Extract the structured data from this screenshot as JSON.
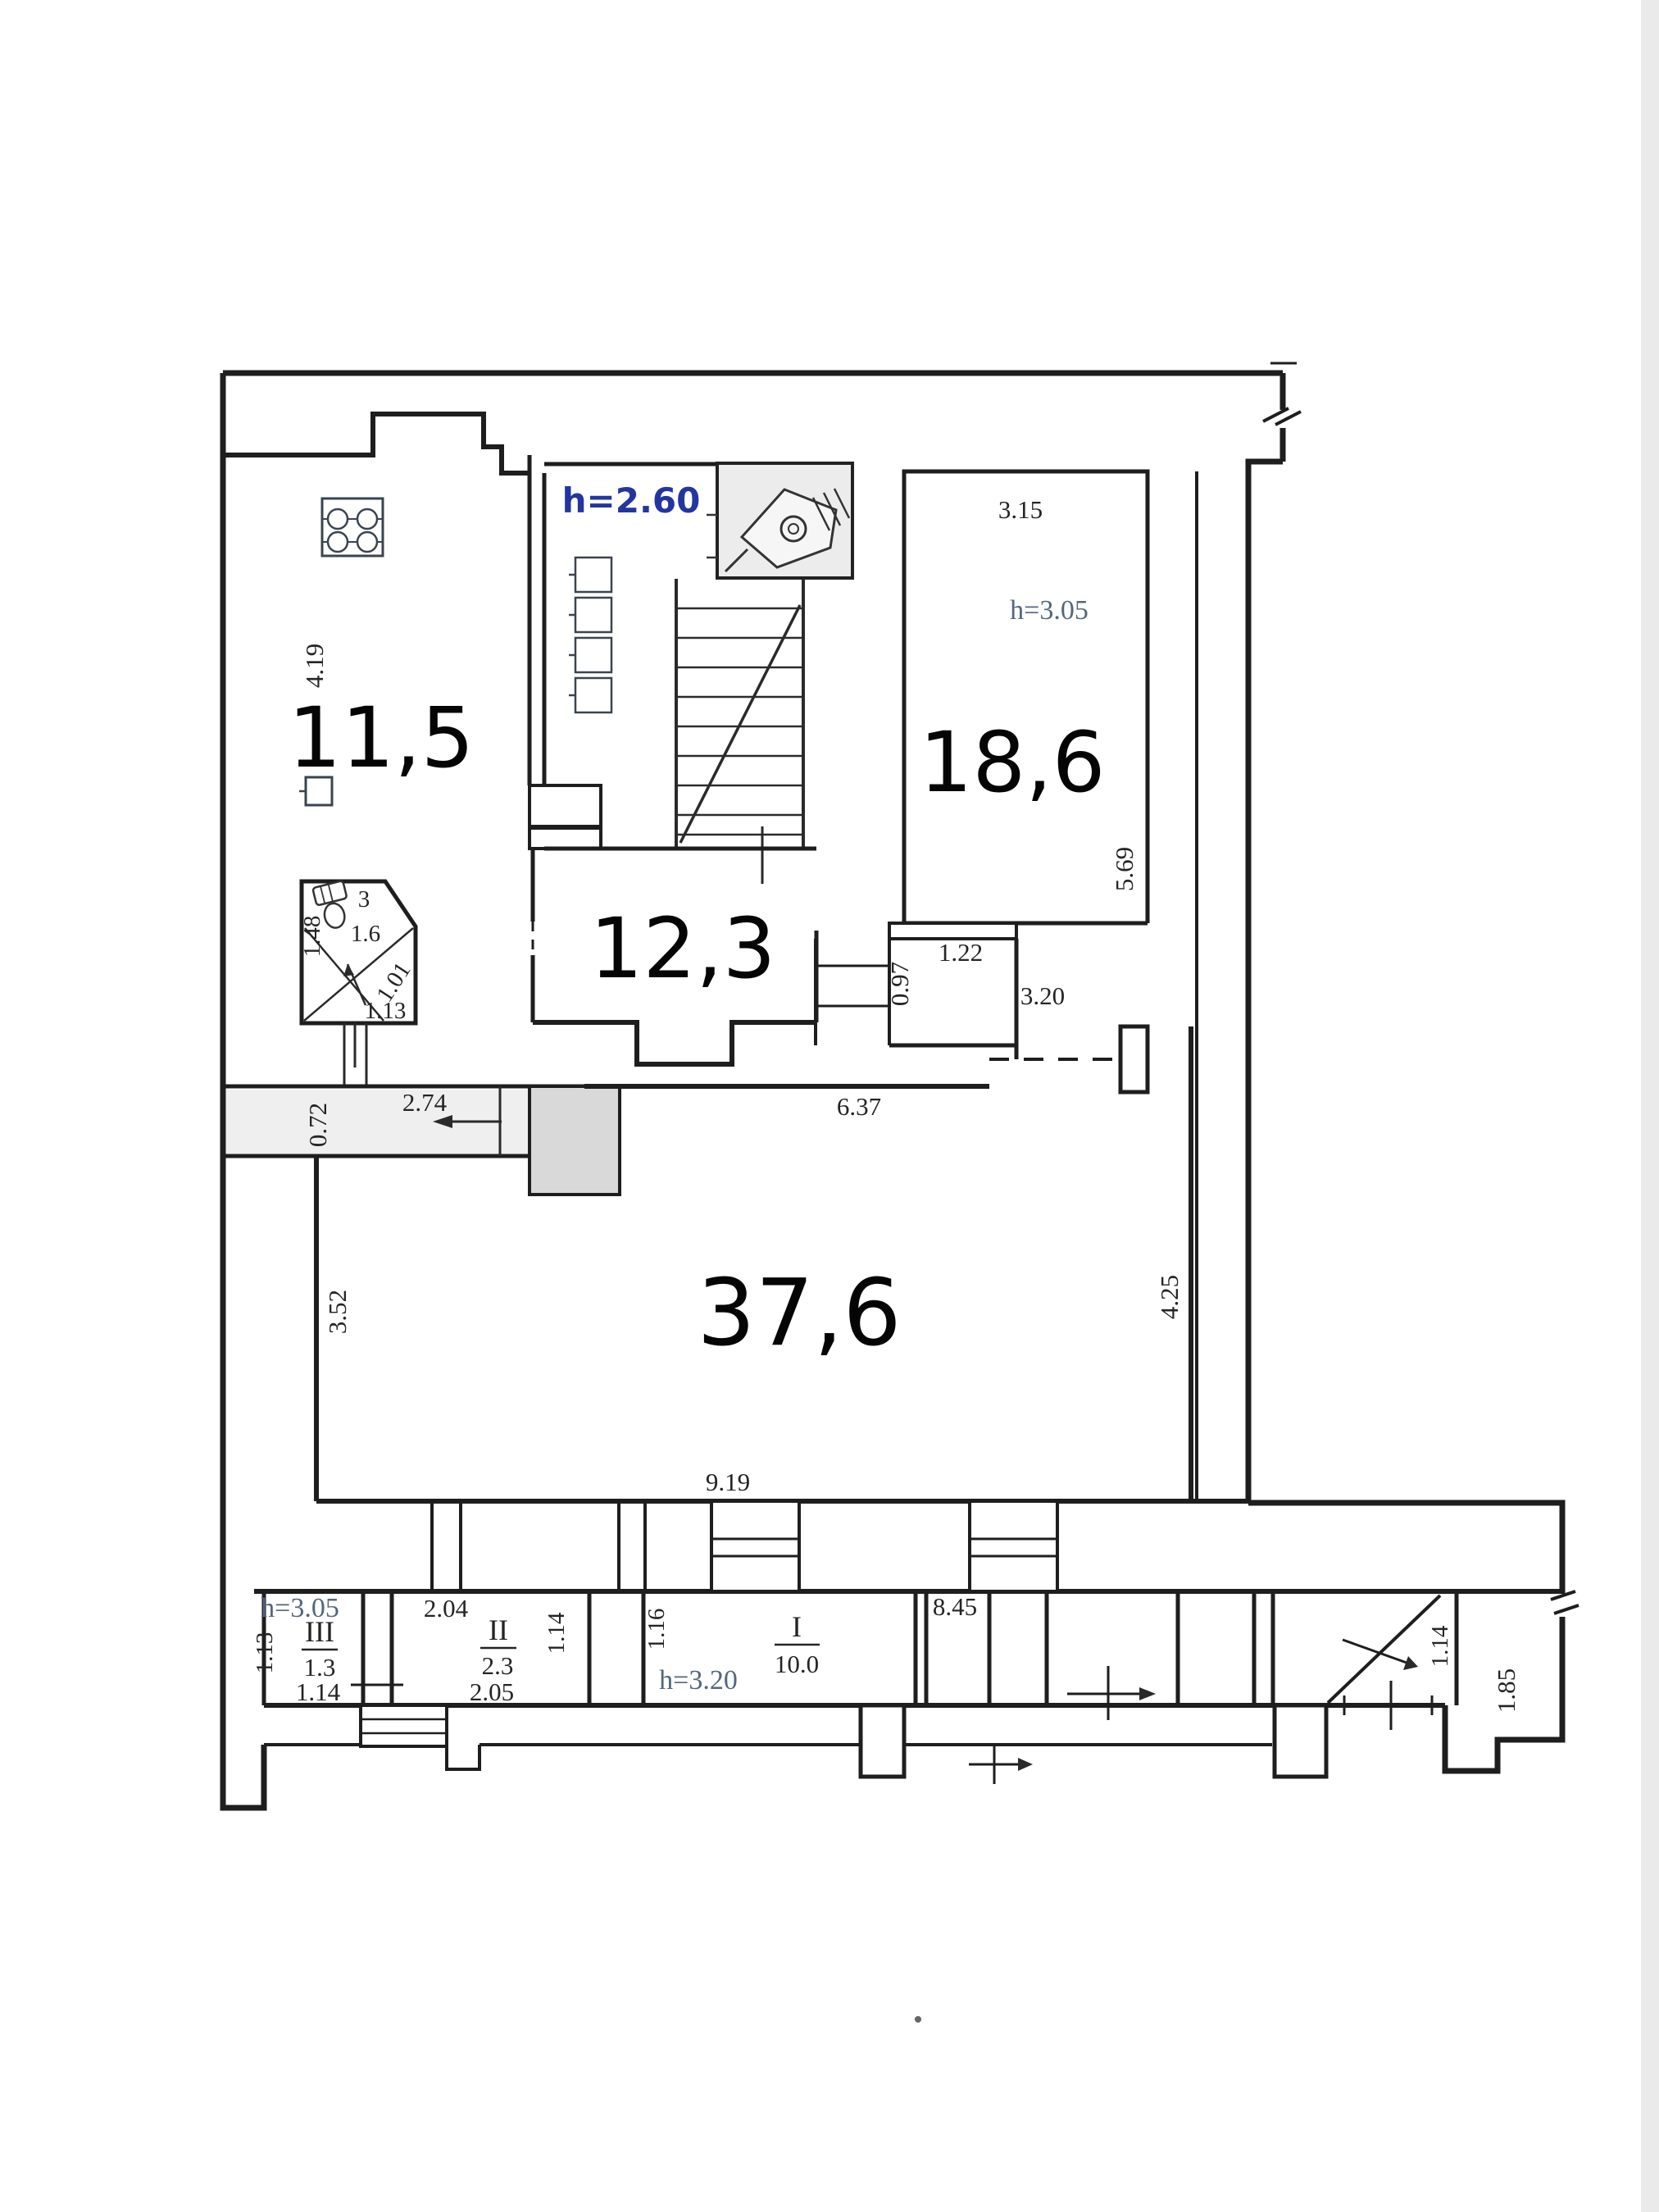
{
  "document": {
    "type": "floor-plan-scan",
    "colors": {
      "wall": "#1e1e1e",
      "dimension_text": "#242424",
      "height_blue": "#2336a0",
      "height_steel": "#54677c",
      "shade_light": "#efefef",
      "shade_mid": "#d9d9d9"
    }
  },
  "labels": {
    "area_11_5": "11,5",
    "area_12_3": "12,3",
    "area_18_6": "18,6",
    "area_37_6": "37,6",
    "h_2_60": "h=2.60",
    "h_3_05_room": "h=3.05",
    "h_3_05_iii": "h=3.05",
    "h_3_20": "h=3.20",
    "d_4_19": "4.19",
    "d_3_15": "3.15",
    "d_5_69": "5.69",
    "wc_num": "3",
    "wc_den": "1.6",
    "d_1_48": "1.48",
    "d_1_01": "1.01",
    "d_1_13_wc": "1.13",
    "d_1_22": "1.22",
    "d_0_97": "0.97",
    "d_3_20": "3.20",
    "d_6_37": "6.37",
    "d_0_72": "0.72",
    "d_2_74": "2.74",
    "d_3_52": "3.52",
    "d_4_25": "4.25",
    "d_9_19": "9.19",
    "d_2_04": "2.04",
    "iii_num": "III",
    "iii_den": "1.3",
    "d_1_14_iii": "1.14",
    "d_1_13_iii": "1.13",
    "ii_num": "II",
    "ii_den": "2.3",
    "d_2_05": "2.05",
    "d_1_14_ii": "1.14",
    "d_1_16": "1.16",
    "i_num": "I",
    "i_den": "10.0",
    "d_8_45": "8.45",
    "d_1_14_right": "1.14",
    "d_1_85": "1.85"
  }
}
